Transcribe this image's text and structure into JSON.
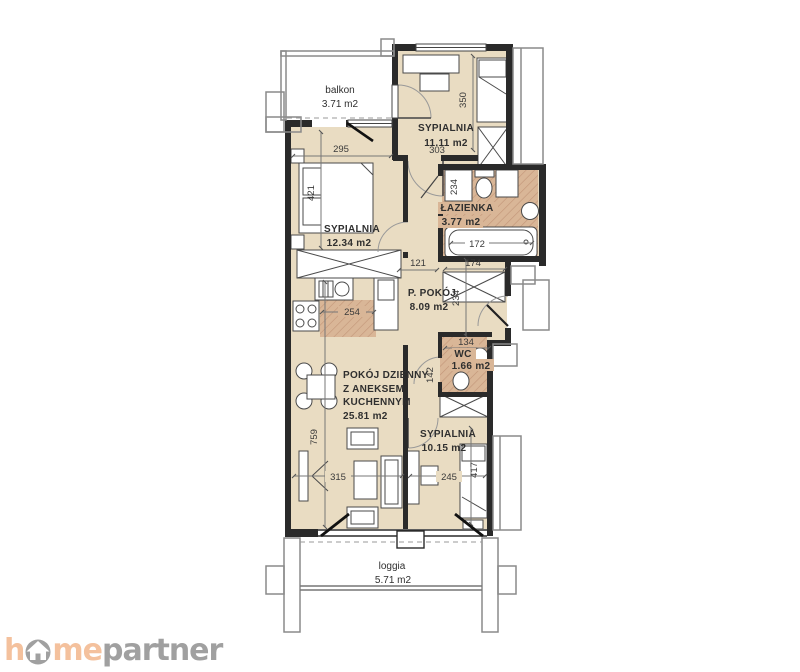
{
  "rooms": {
    "balkon": {
      "name": "balkon",
      "area": "3.71 m2"
    },
    "sypialnia_top": {
      "name": "SYPIALNIA",
      "area": "11.11 m2"
    },
    "sypialnia_left": {
      "name": "SYPIALNIA",
      "area": "12.34 m2"
    },
    "lazienka": {
      "name": "ŁAZIENKA",
      "area": "3.77 m2"
    },
    "p_pokoj": {
      "name": "P. POKÓJ",
      "area": "8.09 m2"
    },
    "wc": {
      "name": "WC",
      "area": "1.66 m2"
    },
    "pokoj_dzienny": {
      "line1": "POKÓJ DZIENNY",
      "line2": "Z ANEKSEM",
      "line3": "KUCHENNYM",
      "area": "25.81 m2"
    },
    "sypialnia_bottom": {
      "name": "SYPIALNIA",
      "area": "10.15 m2"
    },
    "loggia": {
      "name": "loggia",
      "area": "5.71 m2"
    }
  },
  "dims": {
    "d295": "295",
    "d303": "303",
    "d350": "350",
    "d421": "421",
    "d234_bath": "234",
    "d172": "172",
    "d174": "174",
    "d121": "121",
    "d254": "254",
    "d234_hall": "234",
    "d134": "134",
    "d142": "142",
    "d759": "759",
    "d315": "315",
    "d245": "245",
    "d417": "417"
  },
  "logo": {
    "h": "h",
    "me": "me",
    "partner": "partner"
  },
  "colors": {
    "floor": "#e9dcc2",
    "hatch_base": "#d9b697",
    "hatch_line": "#c29577",
    "wall": "#2a2a2a",
    "outline_gray": "#8a8a8a",
    "logo_peach": "#f4c19d",
    "logo_gray": "#a0a0a0"
  }
}
